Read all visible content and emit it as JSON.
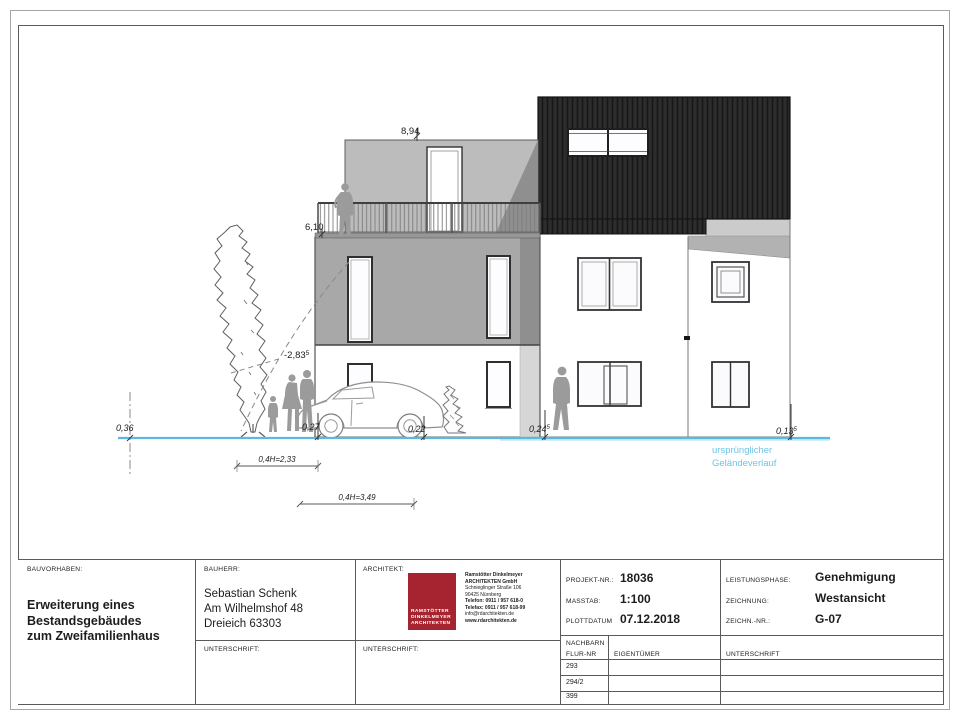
{
  "elevation": {
    "labels": {
      "height_top": "8,94",
      "height_balcony": "6,10",
      "offset_wall": {
        "text": "-2,83",
        "sup": "5"
      },
      "ground_boundary": "0,36",
      "ground_1": "0,27",
      "ground_2": "0,22",
      "ground_3": {
        "text": "0,24",
        "sup": "5"
      },
      "ground_4": {
        "text": "0,13",
        "sup": "5"
      },
      "dim_1": "0,4H=2,33",
      "dim_2": "0,4H=3,49"
    },
    "note": [
      "ursprünglicher",
      "Geländeverlauf"
    ],
    "colors": {
      "ground_line": "#5cb8dd",
      "note_text": "#6cc4e6",
      "roof_dark": "#2d2d2d",
      "wall_gray": "#a8a8a8",
      "penthouse_gray": "#bcbcbc"
    }
  },
  "title_block": {
    "bauvorhaben": {
      "label": "BAUVORHABEN:",
      "lines": [
        "Erweiterung eines",
        "Bestandsgebäudes",
        "zum Zweifamilienhaus"
      ]
    },
    "bauherr": {
      "label": "BAUHERR:",
      "lines": [
        "Sebastian Schenk",
        "Am Wilhelmshof 48",
        "Dreieich 63303"
      ],
      "unterschrift_label": "UNTERSCHRIFT:"
    },
    "architekt": {
      "label": "ARCHITEKT:",
      "unterschrift_label": "UNTERSCHRIFT:",
      "logo_color": "#a6242f",
      "logo_lines": [
        "RAMSTÖTTER",
        "DINKELMEYER",
        "ARCHITEKTEN"
      ],
      "info_lines": [
        "Ramstötter Dinkelmeyer",
        "ARCHITEKTEN GmbH",
        "Schnieglinger Straße 106",
        "90425 Nürnberg",
        "Telefon: 0911 / 957 618-0",
        "Telefax: 0911 / 957 618-99",
        "info@rdarchitekten.de",
        "www.rdarchitekten.de"
      ]
    },
    "project": {
      "projekt_label": "PROJEKT-NR.:",
      "projekt_value": "18036",
      "masstab_label": "MASSTAB:",
      "masstab_value": "1:100",
      "plottdatum_label": "PLOTTDATUM",
      "plottdatum_value": "07.12.2018"
    },
    "phase": {
      "leistungsphase_label": "LEISTUNGSPHASE:",
      "leistungsphase_value": "Genehmigung",
      "zeichnung_label": "ZEICHNUNG:",
      "zeichnung_value": "Westansicht",
      "zeichnnr_label": "ZEICHN.-NR.:",
      "zeichnnr_value": "G-07"
    },
    "nachbarn": {
      "label_line1": "NACHBARN",
      "label_line2": "FLUR-NR",
      "eigentuemer_label": "EIGENTÜMER",
      "unterschrift_label": "UNTERSCHRIFT",
      "rows": [
        "293",
        "294/2",
        "399"
      ]
    }
  }
}
